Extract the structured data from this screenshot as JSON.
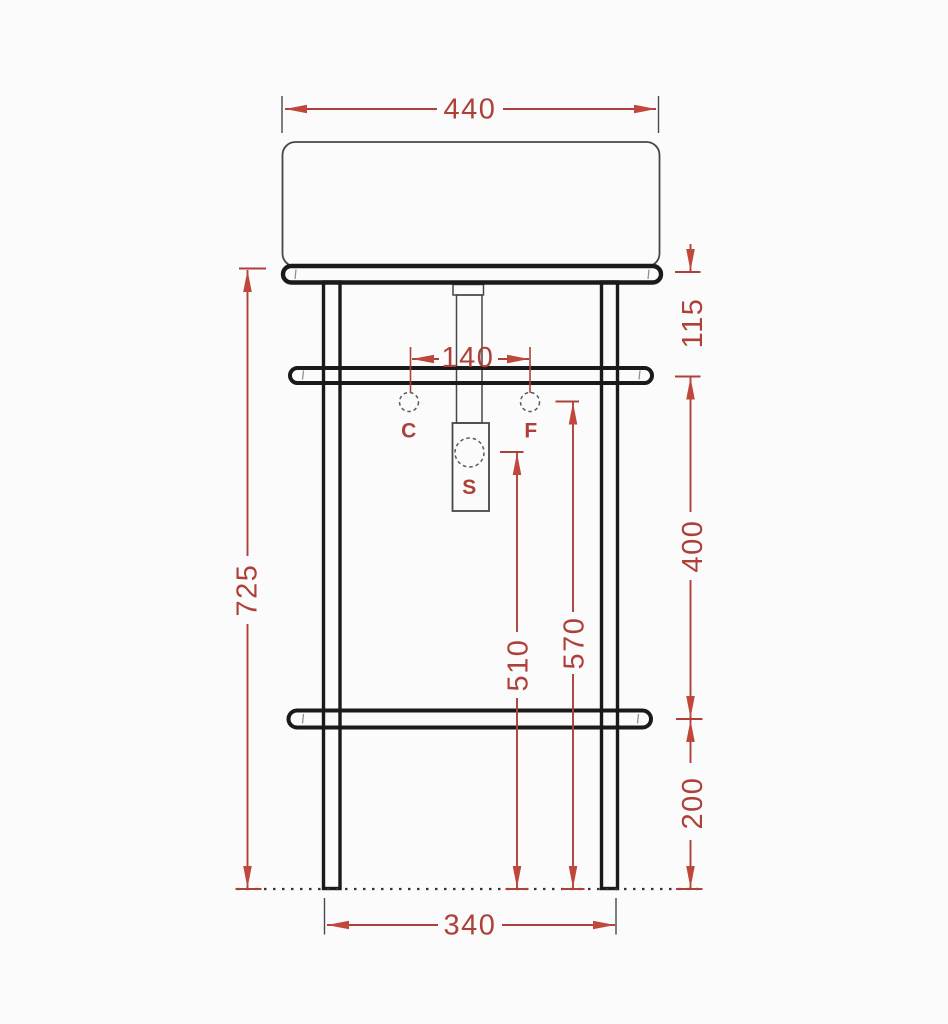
{
  "drawing": {
    "colors": {
      "background": "#fbfbfb",
      "frame_outline": "#1a1a1a",
      "fixture_outline": "#474747",
      "hidden_detail": "#5a5a5a",
      "floor": "#333333",
      "extension": "#4a4a4a",
      "dimension": "#ad4038",
      "arrow": "#c0473b"
    },
    "dimensions": {
      "overall_width": "440",
      "rail_to_upper_crossbar": "115",
      "tap_hole_spacing": "140",
      "total_height": "725",
      "crossbar_spacing": "400",
      "drain_height": "510",
      "supply_height": "570",
      "lower_crossbar_height": "200",
      "leg_spacing": "340"
    },
    "labels": {
      "c": "C",
      "f": "F",
      "s": "S"
    }
  }
}
